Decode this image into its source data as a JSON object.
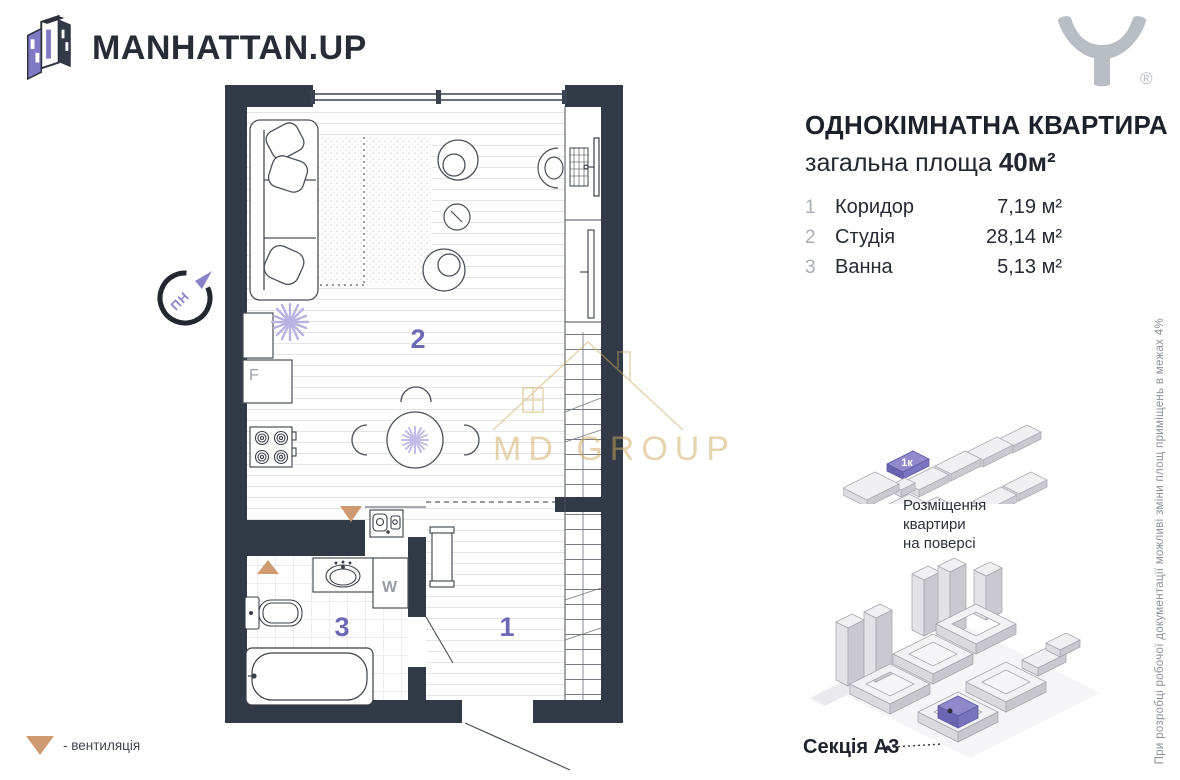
{
  "header": {
    "brand": "MANHATTAN.UP",
    "trademark": "®"
  },
  "apartment": {
    "title": "ОДНОКІМНАТНА КВАРТИРА",
    "area_label": "загальна площа",
    "area_value": "40м²",
    "rooms": [
      {
        "num": "1",
        "name": "Коридор",
        "area": "7,19 м²"
      },
      {
        "num": "2",
        "name": "Студія",
        "area": "28,14 м²"
      },
      {
        "num": "3",
        "name": "Ванна",
        "area": "5,13 м²"
      }
    ]
  },
  "plan": {
    "labels": {
      "studio": "2",
      "bath": "3",
      "hall": "1",
      "fridge": "F",
      "washer": "W",
      "compass": "ПН"
    }
  },
  "watermark": {
    "text": "MD GROUP"
  },
  "floor_diagram": {
    "unit_label": "1к",
    "caption": "Розміщення\nквартири\nна поверсі"
  },
  "building": {
    "section_label": "Секція А3"
  },
  "legend": {
    "ventilation": "- вентиляція"
  },
  "note_vertical": "При розробці робочої документації можливі зміни площ приміщень в межах 4%",
  "colors": {
    "accent_purple": "#6e69b5",
    "wall": "#333a47",
    "ventilation": "#cf9a6f",
    "watermark_gold": "#cdab5e"
  }
}
